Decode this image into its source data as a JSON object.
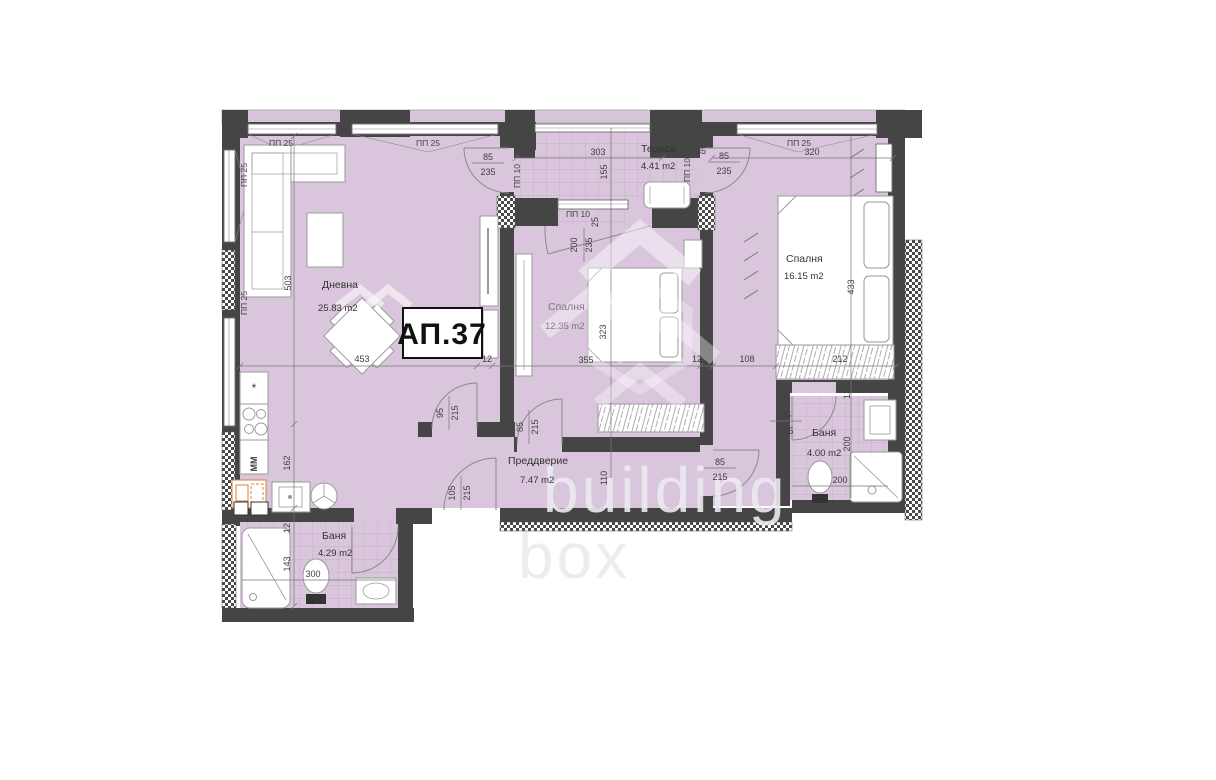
{
  "apartment": {
    "label": "АП.37"
  },
  "watermark": {
    "line1": "building",
    "line2": "box"
  },
  "rooms": {
    "living": {
      "name": "Дневна",
      "area": "25.83 m2"
    },
    "terrace": {
      "name": "Тераса",
      "area": "4.41 m2"
    },
    "bedroom1": {
      "name": "Спалня",
      "area": "16.15 m2"
    },
    "bedroom2": {
      "name": "Спалня",
      "area": "12.35 m2"
    },
    "hall": {
      "name": "Преддверие",
      "area": "7.47 m2"
    },
    "bath1": {
      "name": "Баня",
      "area": "4.00 m2"
    },
    "bath2": {
      "name": "Баня",
      "area": "4.29 m2"
    }
  },
  "windows": {
    "pp25": "ПП 25",
    "pp10": "ПП 10"
  },
  "kitchen": {
    "fridge_mark": "*",
    "dishwasher_label": "ММ"
  },
  "dims": {
    "d12": "12",
    "d25": "25",
    "d35": "35",
    "d85": "85",
    "d95": "95",
    "d105": "105",
    "d108": "108",
    "d110": "110",
    "d143": "143",
    "d155": "155",
    "d162": "162",
    "d200": "200",
    "d212": "212",
    "d215": "215",
    "d235": "235",
    "d300": "300",
    "d303": "303",
    "d320": "320",
    "d323": "323",
    "d355": "355",
    "d433": "433",
    "d453": "453",
    "d503": "503"
  },
  "colors": {
    "room_fill": "#d9c5dc",
    "wall": "#454545",
    "appliance_accent": "#d9823b"
  }
}
